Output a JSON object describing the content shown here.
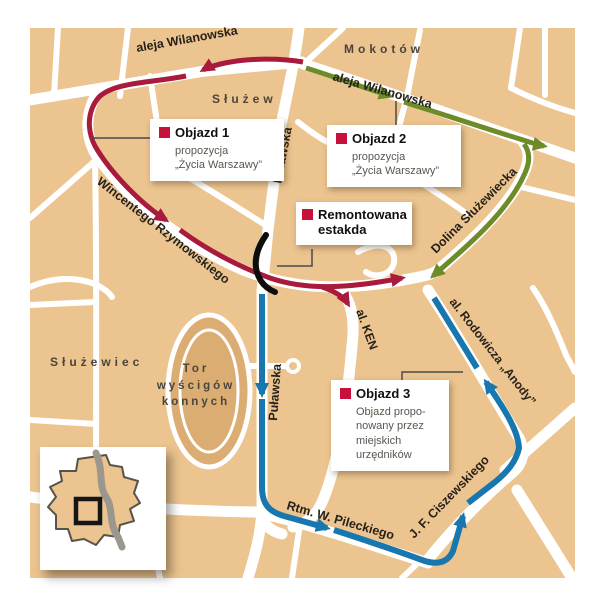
{
  "regions": {
    "mokotow": "Mokotów",
    "sluzew": "Służew",
    "sluzewiec": "Służewiec"
  },
  "racetrack": {
    "line1": "Tor",
    "line2": "wyścigów",
    "line3": "konnych"
  },
  "streets": {
    "wilanowska_west": "aleja Wilanowska",
    "wilanowska_east": "aleja Wilanowska",
    "pulawska_north": "Puławska",
    "pulawska_south": "Puławska",
    "rzymowskiego": "Wincentego Rzymowskiego",
    "dolina": "Dolina Służewiecka",
    "ken": "al. KEN",
    "rodowicza": "al. Rodowicza „Anody”",
    "pileckiego": "Rtm. W. Pileckiego",
    "ciszewskiego": "J. F. Ciszewskiego"
  },
  "callouts": {
    "objazd1": {
      "title": "Objazd 1",
      "body": "propozycja\n„Życia Warszawy”"
    },
    "objazd2": {
      "title": "Objazd 2",
      "body": "propozycja\n„Życia Warszawy”"
    },
    "estakada": {
      "title": "Remontowana estakda"
    },
    "objazd3": {
      "title": "Objazd 3",
      "body": "Objazd propo-\nnowany przez\nmiejskich\nurzędników"
    }
  },
  "colors": {
    "route_detour1": "#a81b3d",
    "route_detour2": "#6d8b28",
    "route_detour3": "#1777ae",
    "land": "#ecc48f",
    "road": "#ffffff",
    "track": "#dbad72",
    "overpass": "#0d0d0d",
    "callout_marker": "#c8103c"
  }
}
